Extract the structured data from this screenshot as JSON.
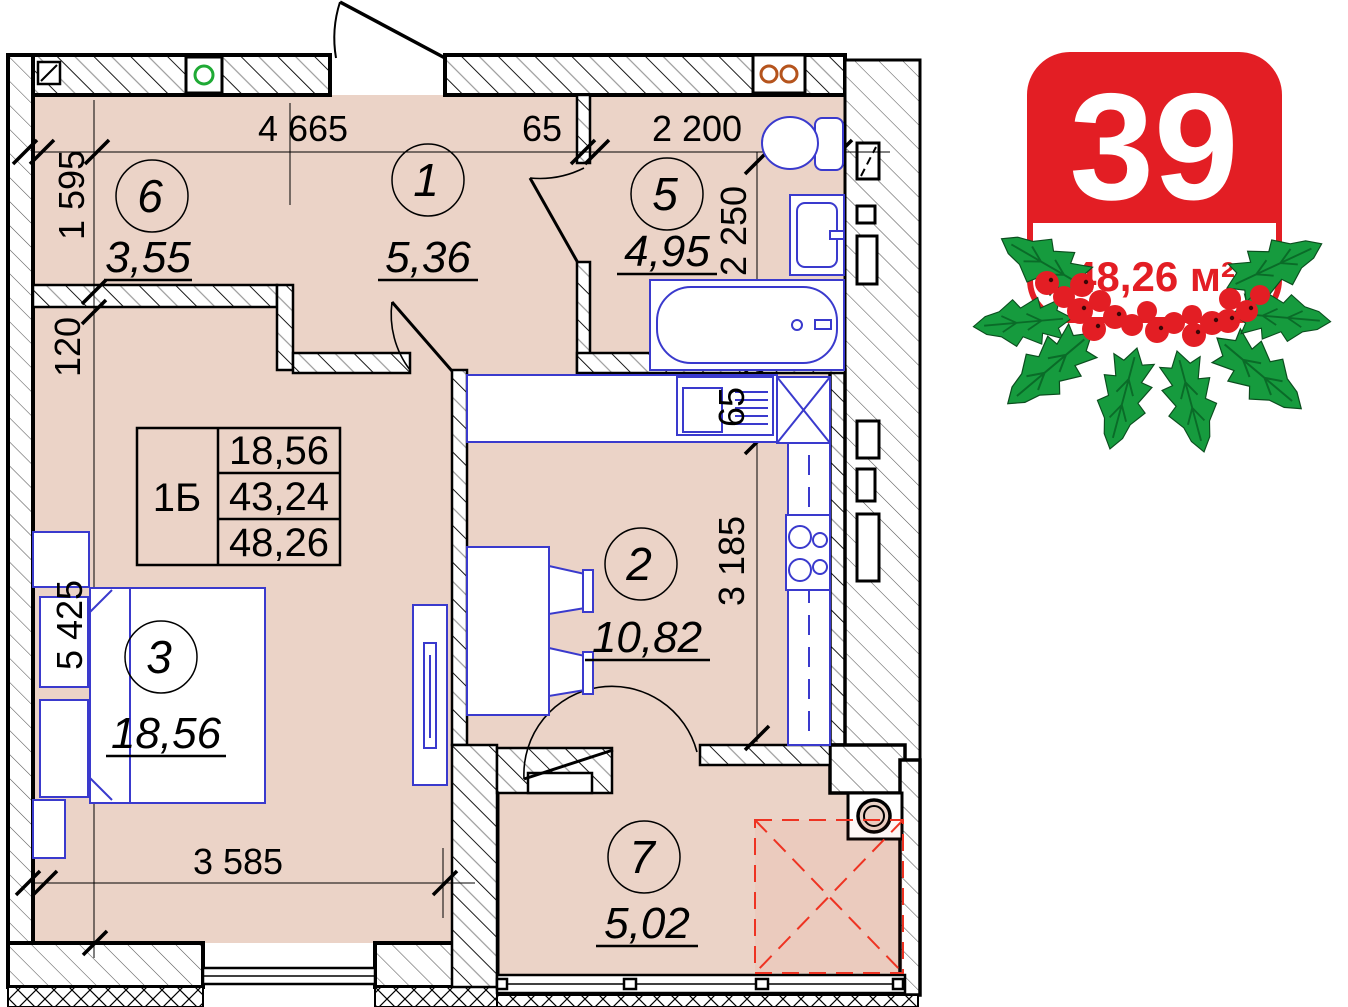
{
  "badge": {
    "number": "39",
    "area_label": "48,26 м²"
  },
  "info_table": {
    "plan_type": "1Б",
    "rows": [
      "18,56",
      "43,24",
      "48,26"
    ]
  },
  "rooms": {
    "r1": {
      "number": "1",
      "area": "5,36"
    },
    "r2": {
      "number": "2",
      "area": "10,82"
    },
    "r3": {
      "number": "3",
      "area": "18,56"
    },
    "r5": {
      "number": "5",
      "area": "4,95"
    },
    "r6": {
      "number": "6",
      "area": "3,55"
    },
    "r7": {
      "number": "7",
      "area": "5,02"
    }
  },
  "dimensions": {
    "top_width": "4 665",
    "top_wall": "65",
    "top_bath": "2 200",
    "left_room6": "1 595",
    "left_wall": "120",
    "left_room3": "5 425",
    "bottom_room3": "3 585",
    "bath_height": "2 250",
    "kitchen_counter": "65",
    "kitchen_height": "3 185"
  },
  "colors": {
    "floor_fill": "#EBD3C7",
    "fixture_blue": "#3A3ACD",
    "badge_red": "#E31E24",
    "holly_green": "#169B3E",
    "reserved_zone_red": "#EE3322",
    "vent_green": "#1FAA35",
    "socket_orange": "#B5541D"
  }
}
